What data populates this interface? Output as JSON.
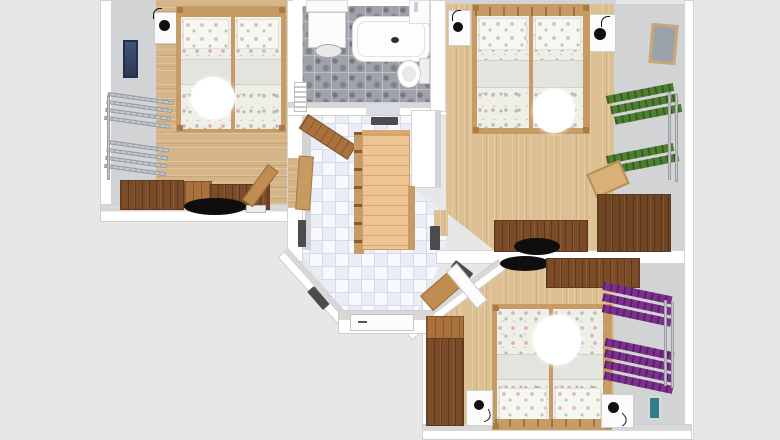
{
  "scene": {
    "type": "3d-floor-plan-top-view",
    "description": "Rendered apartment floor plan with three bedrooms, bathroom and tiled hallway with staircase",
    "background_color": "#e6e7e6",
    "canvas": {
      "width": 780,
      "height": 440
    },
    "visible_text": []
  },
  "palette": {
    "wall_white": "#ffffff",
    "wall_face_gray": "#d2d3d4",
    "wood_floor_left_room": "#d5b487",
    "wood_floor_right_rooms": "#ddc092",
    "dark_wood_furniture": "#7b4c27",
    "mid_wood_furniture": "#a9713c",
    "bed_frame_wood": "#c79b66",
    "stair_wood": "#eec492",
    "hall_tile_white": "#f5f7fa",
    "hall_tile_blue": "#e9edf5",
    "bath_tile_gray": "#a0a2a9",
    "bedding_white": "#eef0e7",
    "doormat_gray": "#4c4c4c",
    "rack_green": "#4e7f31",
    "rack_purple": "#7c2f8e",
    "rack_silver": "#c6c9ce",
    "picture_navy": "#3c4a66",
    "picture_frame_beige": "#c9a878",
    "picture_teal": "#2e7f8a",
    "lamp_black": "#101010"
  },
  "rooms": [
    {
      "id": "bedroom-left",
      "floor": "light wood planks",
      "furniture": [
        "double bed with floral bedding and white throw",
        "white nightstand with black lamp",
        "navy wall picture",
        "silver wall-mounted racks",
        "dark wood sideboard desk",
        "black office chair",
        "small white keyboard",
        "open wooden door"
      ]
    },
    {
      "id": "bathroom",
      "floor": "gray mottled tile",
      "furniture": [
        "bathtub with drain",
        "toilet with tank",
        "washbasin cabinet with oval basin",
        "corner sink",
        "radiator",
        "white shelf"
      ]
    },
    {
      "id": "bedroom-top-right",
      "floor": "light wood planks",
      "furniture": [
        "double bed with floral bedding and white throw",
        "two white nightstands with black lamps",
        "beige framed wall picture",
        "two green wall-mounted racks",
        "light wooden stool",
        "dark wood desks",
        "black office chair"
      ]
    },
    {
      "id": "hallway",
      "floor": "white and pale-blue checkered tile",
      "furniture": [
        "wooden staircase with railings",
        "diagonal wooden bench",
        "wood wall board",
        "white entrance door with handle",
        "five dark gray doormats",
        "open white door"
      ]
    },
    {
      "id": "bedroom-bottom-right",
      "floor": "light wood planks",
      "furniture": [
        "double bed with floral bedding and white throw",
        "two white nightstands with black lamps",
        "two purple wall-mounted racks",
        "dark wood wardrobe",
        "dark wood desk",
        "black office chair",
        "teal wall picture",
        "corner wood shelf",
        "open white door"
      ]
    }
  ]
}
